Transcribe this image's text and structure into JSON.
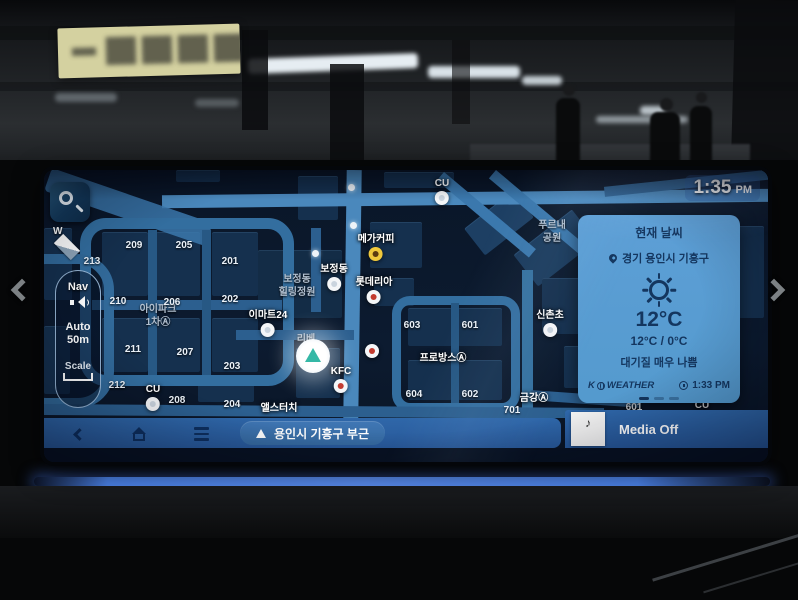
{
  "statusbar": {
    "time": "1:35",
    "meridiem": "PM"
  },
  "controls": {
    "compass": "W",
    "nav": "Nav",
    "auto_scale": "Auto\n50m",
    "scale": "Scale"
  },
  "weather": {
    "title": "현재 날씨",
    "location": "경기 용인시 기흥구",
    "temperature": "12°C",
    "range": "12°C / 0°C",
    "air_quality": "대기질 매우 나쁨",
    "provider_k": "K",
    "provider_weather": "WEATHER",
    "updated": "1:33 PM"
  },
  "bottom_bar": {
    "current_location": "용인시 기흥구 부근",
    "media_status": "Media Off"
  },
  "map": {
    "areas": [
      {
        "t": "푸르내\n공원",
        "x": 508,
        "y": 50
      },
      {
        "t": "보정동\n힐링정원",
        "x": 253,
        "y": 104
      },
      {
        "t": "아이파크\n1차Ⓐ",
        "x": 114,
        "y": 134
      },
      {
        "t": "리베\n3",
        "x": 262,
        "y": 164
      }
    ],
    "numbers": [
      {
        "t": "209",
        "x": 90,
        "y": 70
      },
      {
        "t": "205",
        "x": 140,
        "y": 70
      },
      {
        "t": "213",
        "x": 48,
        "y": 86
      },
      {
        "t": "201",
        "x": 186,
        "y": 86
      },
      {
        "t": "210",
        "x": 74,
        "y": 126
      },
      {
        "t": "206",
        "x": 128,
        "y": 127
      },
      {
        "t": "202",
        "x": 186,
        "y": 124
      },
      {
        "t": "211",
        "x": 89,
        "y": 174
      },
      {
        "t": "207",
        "x": 141,
        "y": 177
      },
      {
        "t": "203",
        "x": 188,
        "y": 191
      },
      {
        "t": "212",
        "x": 73,
        "y": 210
      },
      {
        "t": "208",
        "x": 133,
        "y": 225
      },
      {
        "t": "204",
        "x": 188,
        "y": 229
      },
      {
        "t": "603",
        "x": 368,
        "y": 150
      },
      {
        "t": "601",
        "x": 426,
        "y": 150
      },
      {
        "t": "604",
        "x": 370,
        "y": 219
      },
      {
        "t": "602",
        "x": 426,
        "y": 219
      },
      {
        "t": "701",
        "x": 468,
        "y": 235
      },
      {
        "t": "601",
        "x": 590,
        "y": 232
      }
    ],
    "pois": [
      {
        "t": "CU",
        "x": 398,
        "y": 8,
        "c": "white"
      },
      {
        "t": "메가커피",
        "x": 332,
        "y": 60,
        "c": "yellow"
      },
      {
        "t": "보정동",
        "x": 290,
        "y": 90,
        "c": "white"
      },
      {
        "t": "롯데리아",
        "x": 330,
        "y": 103,
        "c": "red"
      },
      {
        "t": "이마트24",
        "x": 224,
        "y": 136,
        "c": "white"
      },
      {
        "t": "KFC",
        "x": 297,
        "y": 196,
        "c": "red"
      },
      {
        "t": "신촌초",
        "x": 506,
        "y": 136,
        "c": "white"
      },
      {
        "t": "CU",
        "x": 109,
        "y": 214,
        "c": "white"
      },
      {
        "t": "",
        "x": 328,
        "y": 172,
        "c": "red"
      },
      {
        "t": "프로방스Ⓐ",
        "x": 399,
        "y": 179,
        "c": "none"
      },
      {
        "t": "금강Ⓐ",
        "x": 490,
        "y": 219,
        "c": "none"
      },
      {
        "t": "앨스터치",
        "x": 235,
        "y": 229,
        "c": "none"
      },
      {
        "t": "CU",
        "x": 658,
        "y": 230,
        "c": "none"
      }
    ]
  }
}
